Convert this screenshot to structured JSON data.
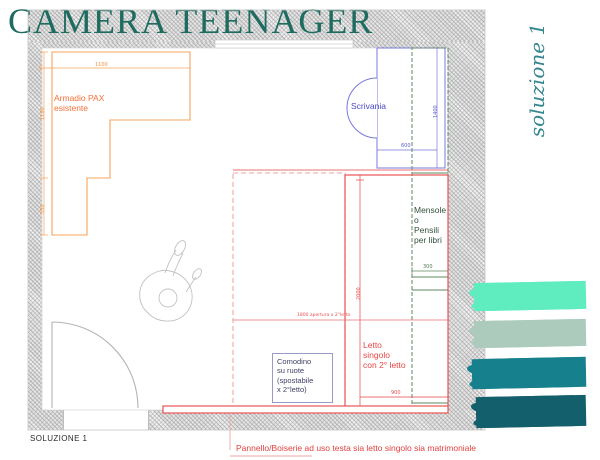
{
  "title": "CAMERA TEENAGER",
  "solution_script": "soluzione 1",
  "solution_label": "SOLUZIONE 1",
  "plan": {
    "armadio": {
      "label": "Armadio PAX\nesistente",
      "dim_top": "1100",
      "dim_left_upper": "1100",
      "dim_left_lower": "550"
    },
    "scrivania": {
      "label": "Scrivania",
      "dim_length": "1400",
      "dim_depth": "600"
    },
    "mensole": {
      "label": "Mensole\no\nPensili\nper libri",
      "dim_depth": "300"
    },
    "letto": {
      "label": "Letto\nsingolo\ncon 2° letto",
      "dim_length": "2000",
      "dim_width": "900",
      "dim_opening": "1800 apertura x 2°letto"
    },
    "comodino": {
      "label": "Comodino\nsu ruote\n(spostabile\nx 2°letto)"
    },
    "pannello": {
      "caption": "Pannello/Boiserie ad uso testa sia letto singolo sia matrimoniale"
    }
  },
  "palette": {
    "mint": "#5fedc0",
    "sage": "#accbbc",
    "teal": "#17808d",
    "dark_teal": "#135f6c",
    "title_color": "#1e6b60",
    "accent_orange": "#f5a45c",
    "accent_blue": "#7878dc",
    "accent_green": "#5e8a60",
    "accent_red": "#e84545"
  }
}
